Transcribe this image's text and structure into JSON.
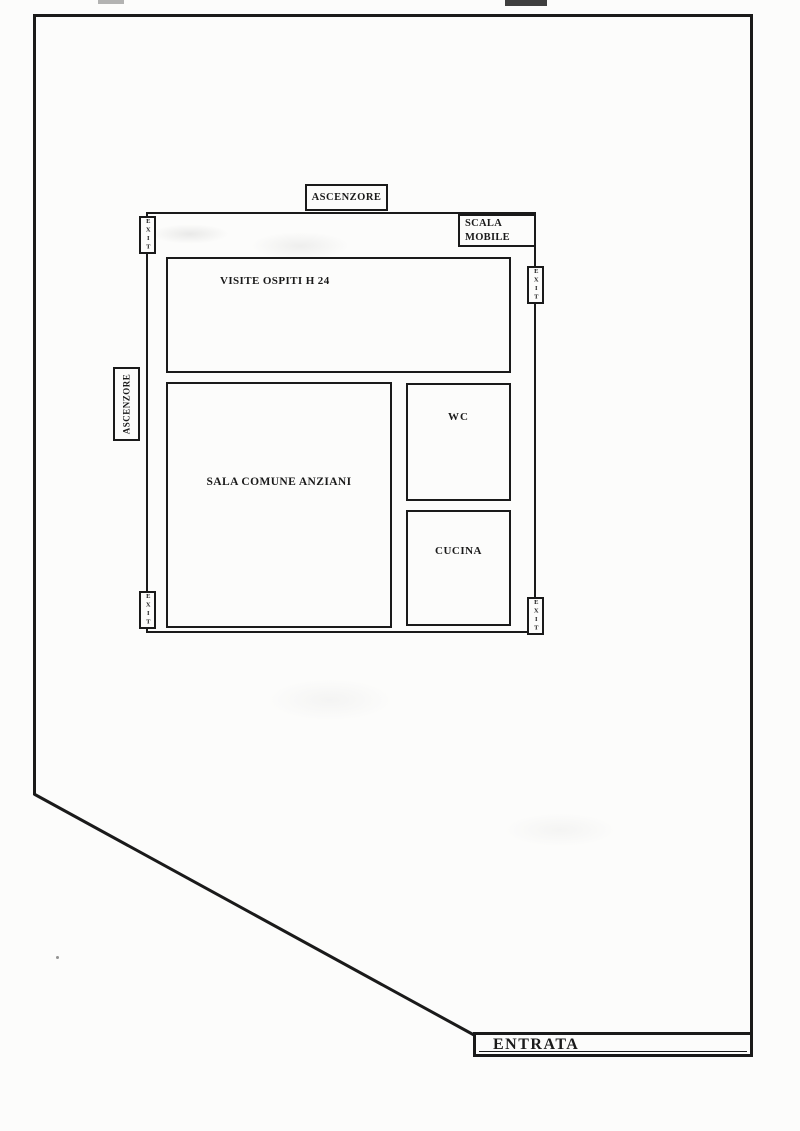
{
  "document": {
    "type": "floor-plan",
    "language": "it",
    "line_color": "#1a1a1a",
    "paper_color": "#fcfcfb"
  },
  "plan": {
    "elevator_top": {
      "label": "ASCENZORE"
    },
    "escalator": {
      "label": "SCALA MOBILE"
    },
    "elevator_left": {
      "label": "ASCENZORE"
    },
    "rooms": [
      {
        "id": "visite",
        "label": "VISITE OSPITI H 24"
      },
      {
        "id": "sala",
        "label": "SALA COMUNE ANZIANI"
      },
      {
        "id": "wc",
        "label": "WC"
      },
      {
        "id": "cucina",
        "label": "CUCINA"
      }
    ],
    "exits": [
      "EXIT",
      "EXIT",
      "EXIT",
      "EXIT"
    ],
    "entrance": {
      "label": "ENTRATA"
    }
  }
}
